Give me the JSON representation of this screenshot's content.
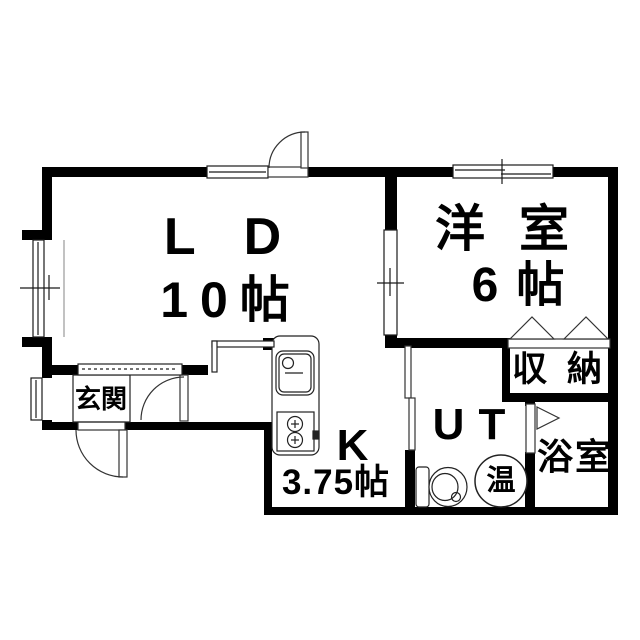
{
  "diagram_type": "floor-plan",
  "rooms": {
    "living_dining": {
      "label": "LD",
      "size": "10帖"
    },
    "western_room": {
      "label": "洋室",
      "size": "6帖"
    },
    "kitchen": {
      "label": "K",
      "size": "3.75帖"
    },
    "utility": {
      "label": "UT"
    },
    "bathroom": {
      "label": "浴室"
    },
    "storage": {
      "label": "収納"
    },
    "entrance": {
      "label": "玄関"
    }
  },
  "fixtures": {
    "water_heater": {
      "label": "温"
    }
  },
  "colors": {
    "wall": "#000000",
    "background": "#ffffff",
    "outline": "#1a1a1a"
  }
}
